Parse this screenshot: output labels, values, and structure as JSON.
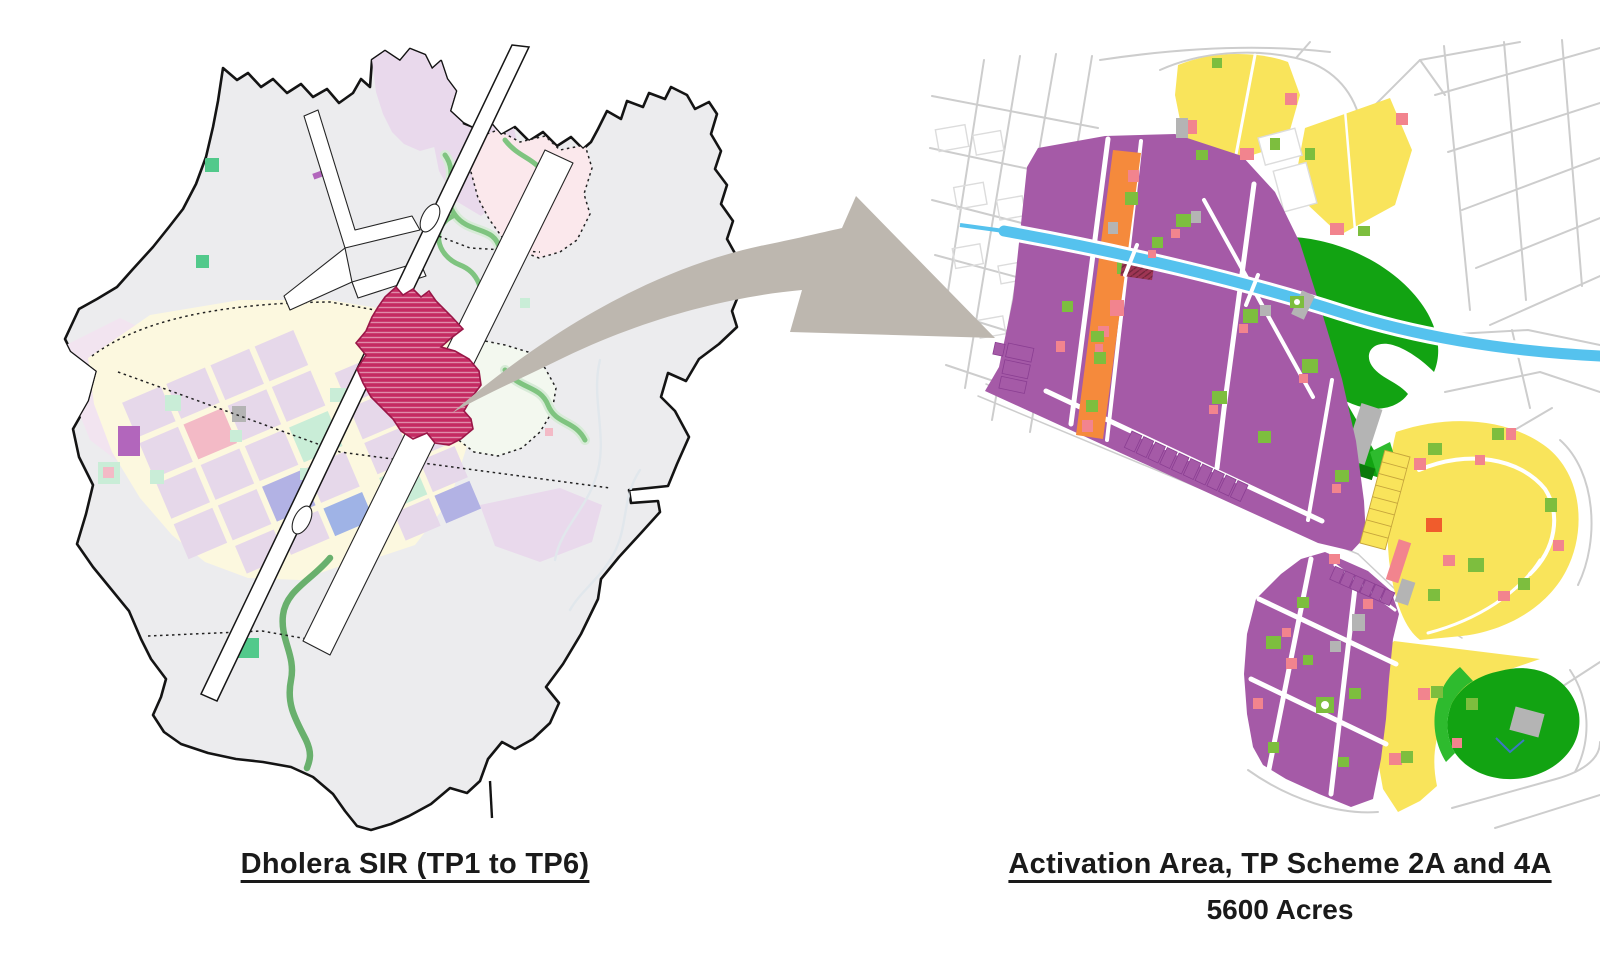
{
  "page": {
    "background": "#ffffff",
    "type_hint": "land-use planning slide with two maps connected by an arrow"
  },
  "left_map": {
    "caption": "Dholera SIR (TP1 to TP6)",
    "highlight": "activation area (hatched crimson zone)"
  },
  "right_map": {
    "caption": "Activation Area, TP Scheme 2A and 4A",
    "subcaption": "5600 Acres"
  },
  "arrow": {
    "meaning": "zoom-in from SIR activation zone to detailed TP scheme map"
  },
  "colors": {
    "background": "#ffffff",
    "ink": "#1a1a1a",
    "map_gray": "#ececee",
    "boundary": "#141414",
    "lavender": "#e9d9ec",
    "grid_lavender": "#e6d8ea",
    "pale_yellow": "#fcf8df",
    "pink_zone": "#fbe8ec",
    "pale_green_zone": "#f3f8ef",
    "river_green": "#7fc480",
    "crimson": "#c52a62",
    "crimson_border": "#9a1748",
    "arrow": "#bdb7af",
    "purple": "#a55aa7",
    "purple_line": "#8a3e92",
    "orange": "#f58a3c",
    "yellow": "#f9e45b",
    "green_dark": "#12a312",
    "green_mid": "#2ebb2e",
    "green_lime": "#7dbe3e",
    "salmon": "#f2848e",
    "red_orange": "#f05c2c",
    "canal_blue": "#55c2ee",
    "patch_gray": "#b4b4b4",
    "road_gray": "#cdcdcd",
    "dark_red": "#9e3553"
  }
}
